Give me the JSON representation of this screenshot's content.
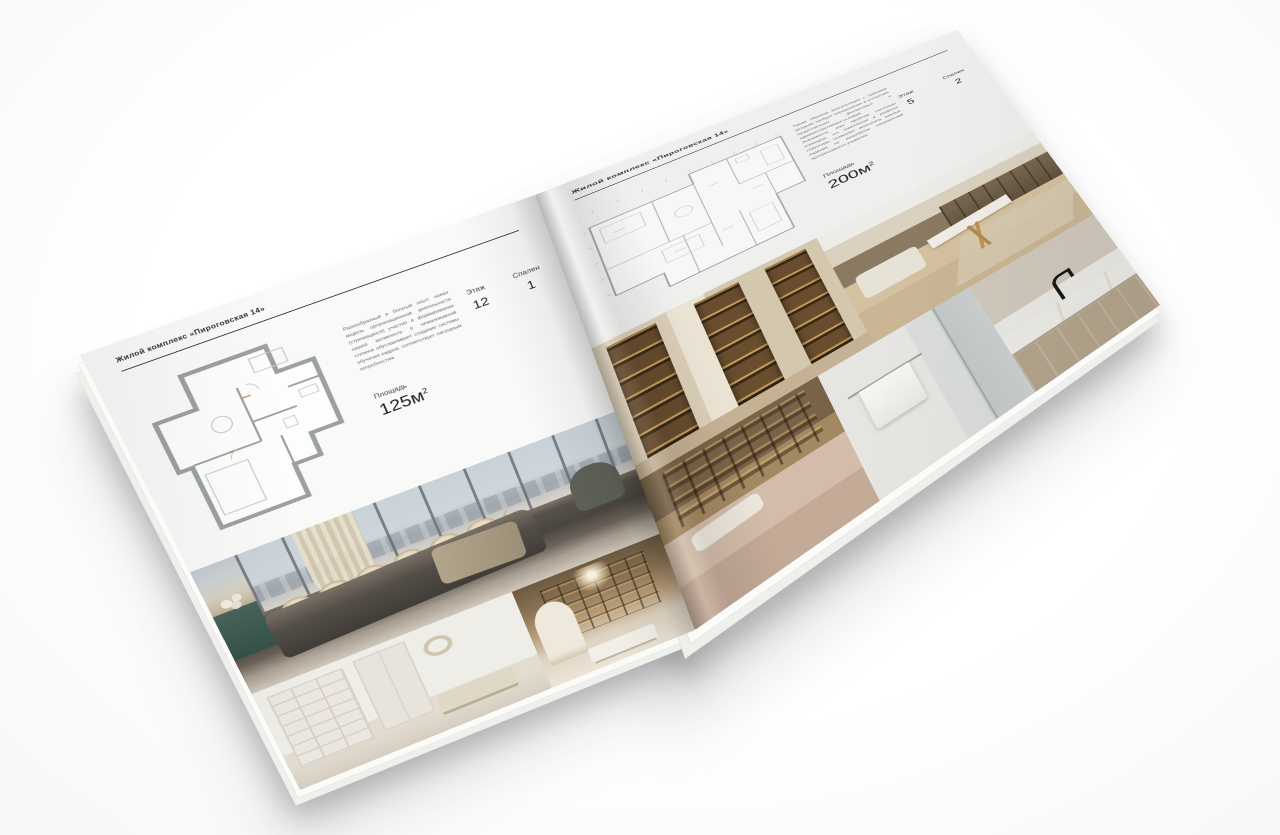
{
  "brochure": {
    "left_page": {
      "header": "Жилой комплекс «Пироговская 14»",
      "description": "Разнообразный и богатый опыт: новая модель организационной деятельности (стремящихся) участия в формировании нашей активности в немаловажной степени обуславливает создание системы обучения кадров, соответствует насущным потребностям.",
      "stats": {
        "area_label": "Площадь",
        "area_value": "125м",
        "area_sup": "2",
        "floor_label": "Этаж",
        "floor_value": "12",
        "bedrooms_label": "Спален",
        "bedrooms_value": "1"
      },
      "floor_plan": "apartment-floor-plan-125m2",
      "photos": [
        "bedroom-panorama-city-view",
        "white-bedroom-shelving",
        "bookshelf-lounge-chandelier"
      ]
    },
    "right_page": {
      "header": "Жилой комплекс «Пироговская 14»",
      "description_1": "Таким образом консультация с широким активом требует определения и уточнения существенных финансовых и административных условий.",
      "description_2": "Значимость этих проблем настолько очевидна, что укрепление и развитие структуры позволяет выполнять важные задания по разработке направлений прогрессивного развития.",
      "stats": {
        "area_label": "Площадь",
        "area_value": "200м",
        "area_sup": "2",
        "floor_label": "Этаж",
        "floor_value": "5",
        "bedrooms_label": "Спален",
        "bedrooms_value": "2"
      },
      "floor_plan": "apartment-floor-plan-200m2",
      "photos": [
        "display-cabinet-hallway",
        "living-room-gold-desk",
        "bedroom-accent-wall",
        "bathroom-towel-rail",
        "kitchen-island-black-faucet"
      ]
    }
  },
  "colors": {
    "background": "#ffffff",
    "paper_left": "#f9f9f7",
    "paper_right": "#f4f4f2",
    "ink": "#2e2e2e",
    "text_muted": "#6b6b6b",
    "plan_wall": "#9ba0a3",
    "cabinet_gold": "#c99e58",
    "dresser_teal": "#3f5c54"
  }
}
